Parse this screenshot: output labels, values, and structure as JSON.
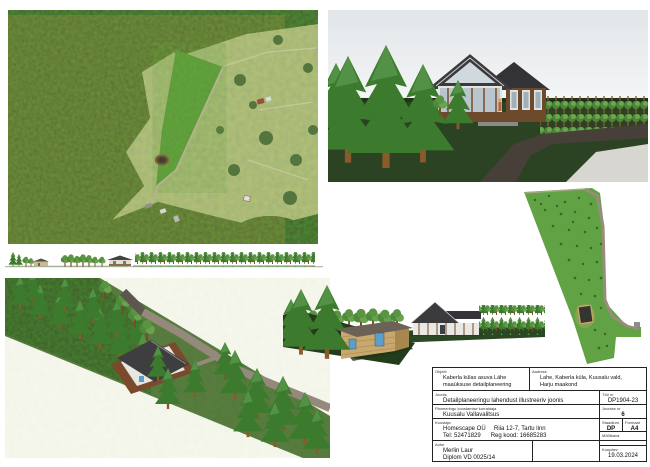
{
  "title_block": {
    "object": {
      "label": "Objekt",
      "value": "Kaberla külas asuva Lähe\nmaaüksuse detailplaneering"
    },
    "address": {
      "label": "Aadress",
      "value": "Lahe, Kaberla küla, Kuusalu vald,\nHarju maakond"
    },
    "drawing": {
      "label": "Joonis",
      "value": "Detailplaneeringu lahendust illustreeriv joonis"
    },
    "organizer": {
      "label": "Planeeringu koostamise korraldaja",
      "value": "Kuusalu Vallavalitsus"
    },
    "company": {
      "label": "Koostaja",
      "value": "Homescape OÜ     Riia 12-7, Tartu linn\nTel: 52471829      Reg kood: 16685283"
    },
    "author": {
      "label": "Autor",
      "value": "Merlin Laur\nDiplom VD 0025/14"
    },
    "work_no": {
      "label": "Töö nr",
      "value": "DP1904-23"
    },
    "sheet_no": {
      "label": "Joonise nr",
      "value": "6"
    },
    "stage": {
      "label": "Staadium",
      "value": "DP"
    },
    "format": {
      "label": "Formaat",
      "value": "A4"
    },
    "scale": {
      "label": "Mõõtkava",
      "value": ""
    },
    "date": {
      "label": "Kuupäev",
      "value": "19.03.2024"
    }
  },
  "colors": {
    "page_bg": "#ffffff",
    "sky": "#e8ebee",
    "ground_dark_green": "#2c4323",
    "forest_dark": "#2c4a20",
    "plot_bright_green": "#5f9e3a",
    "siteplan_green": "#61a245",
    "roof_dark": "#3a393b",
    "wood_tan": "#c9a86d",
    "spruce_green": "#3c7a2e",
    "road_asphalt": "#474038",
    "road_gravel": "#9a8c7c",
    "border": "#222222"
  }
}
